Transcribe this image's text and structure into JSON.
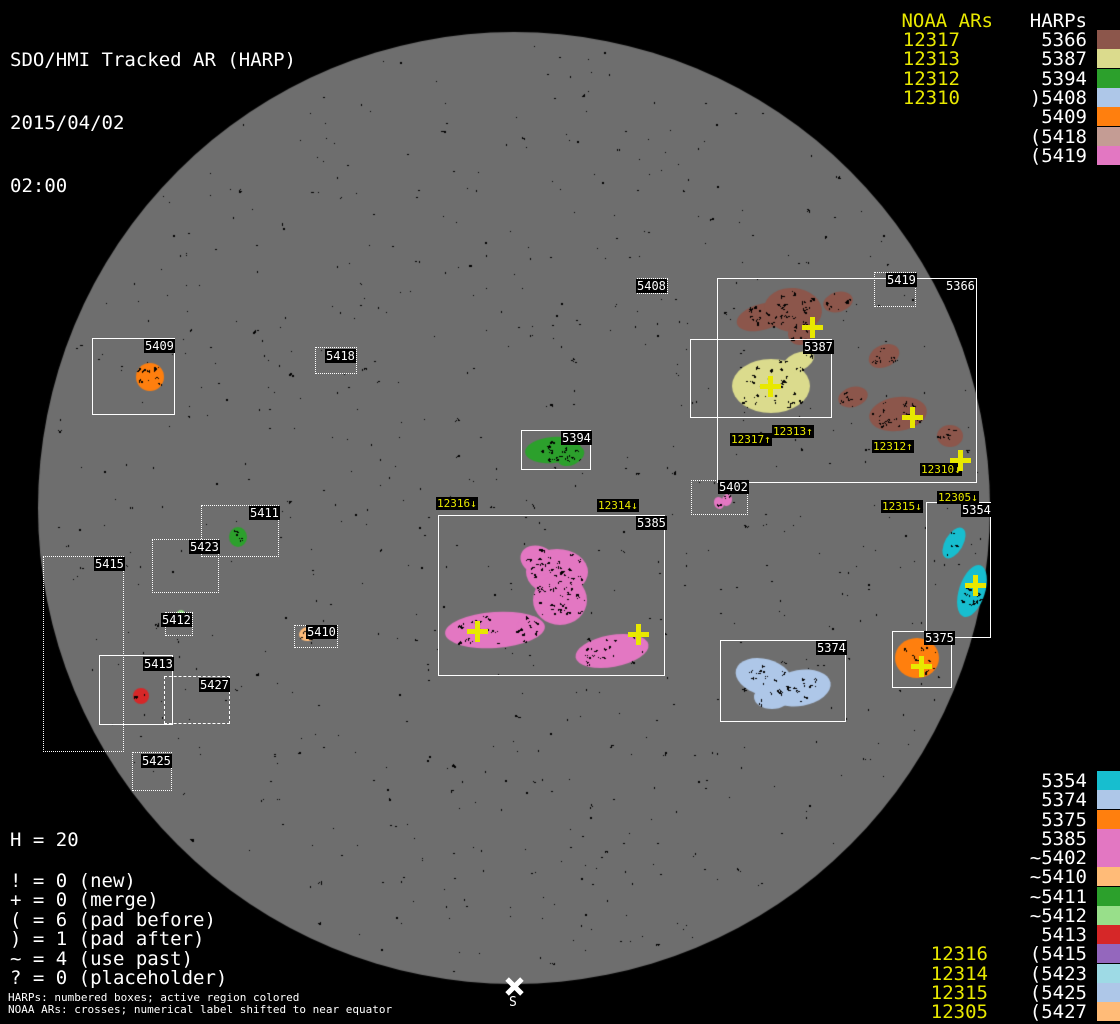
{
  "title": {
    "line1": "SDO/HMI Tracked AR (HARP)",
    "line2": "2015/04/02",
    "line3": "02:00"
  },
  "colors": {
    "background": "#000000",
    "disk_gray": "#6e6e6e",
    "box_white": "#ffffff",
    "noaa_yellow": "#e8e800",
    "label_bg": "#000000"
  },
  "disk": {
    "cx": 514,
    "cy": 508,
    "r": 476,
    "south_label": "S"
  },
  "legend_top_right": {
    "noaa_header": "NOAA ARs",
    "harp_header": "HARPs",
    "rows": [
      {
        "noaa": "12317",
        "label": "5366",
        "color": "#8c564b"
      },
      {
        "noaa": "12313",
        "label": "5387",
        "color": "#dbdb8d"
      },
      {
        "noaa": "12312",
        "label": "5394",
        "color": "#2ca02c"
      },
      {
        "noaa": "12310",
        "label": ")5408",
        "color": "#aec7e8"
      },
      {
        "noaa": "",
        "label": "5409",
        "color": "#ff7f0e"
      },
      {
        "noaa": "",
        "label": "(5418",
        "color": "#c49c94"
      },
      {
        "noaa": "",
        "label": "(5419",
        "color": "#e377c2"
      }
    ]
  },
  "legend_bottom_right": {
    "rows": [
      {
        "noaa": "",
        "label": "5354",
        "color": "#17becf"
      },
      {
        "noaa": "",
        "label": "5374",
        "color": "#aec7e8"
      },
      {
        "noaa": "",
        "label": "5375",
        "color": "#ff7f0e"
      },
      {
        "noaa": "",
        "label": "5385",
        "color": "#e377c2"
      },
      {
        "noaa": "",
        "label": "~5402",
        "color": "#e377c2"
      },
      {
        "noaa": "",
        "label": "~5410",
        "color": "#ffbb78"
      },
      {
        "noaa": "",
        "label": "~5411",
        "color": "#2ca02c"
      },
      {
        "noaa": "",
        "label": "~5412",
        "color": "#98df8a"
      },
      {
        "noaa": "",
        "label": "5413",
        "color": "#d62728"
      },
      {
        "noaa": "12316",
        "label": "(5415",
        "color": "#9467bd"
      },
      {
        "noaa": "12314",
        "label": "(5423",
        "color": "#9edae5"
      },
      {
        "noaa": "12315",
        "label": "(5425",
        "color": "#aec7e8"
      },
      {
        "noaa": "12305",
        "label": "(5427",
        "color": "#ffbb78"
      }
    ]
  },
  "stats": {
    "total": "H = 20",
    "items": [
      "! = 0 (new)",
      "+ = 0 (merge)",
      "( = 6 (pad before)",
      ") = 1 (pad after)",
      "~ = 4 (use past)",
      "? = 0 (placeholder)"
    ]
  },
  "footer": {
    "line1": "HARPs: numbered boxes; active region colored",
    "line2": "NOAA ARs: crosses; numerical label shifted to near equator"
  },
  "chart_data": {
    "type": "map",
    "title": "SDO/HMI Tracked AR (HARP)",
    "datetime": "2015/04/02 02:00",
    "harp_total": 20,
    "harp_boxes": [
      {
        "id": "5366",
        "x": 717,
        "y": 278,
        "w": 260,
        "h": 205,
        "border": "solid",
        "lx": 945,
        "ly": 279
      },
      {
        "id": "5419",
        "x": 874,
        "y": 272,
        "w": 42,
        "h": 35,
        "border": "dotted",
        "lx": 886,
        "ly": 273
      },
      {
        "id": "5387",
        "x": 690,
        "y": 339,
        "w": 142,
        "h": 79,
        "border": "solid",
        "lx": 803,
        "ly": 340
      },
      {
        "id": "5409",
        "x": 92,
        "y": 338,
        "w": 83,
        "h": 77,
        "border": "solid",
        "lx": 144,
        "ly": 339
      },
      {
        "id": "5418",
        "x": 315,
        "y": 347,
        "w": 42,
        "h": 27,
        "border": "dotted",
        "lx": 325,
        "ly": 349
      },
      {
        "id": "5408",
        "x": 637,
        "y": 278,
        "w": 31,
        "h": 16,
        "border": "dotted",
        "lx": 636,
        "ly": 279
      },
      {
        "id": "5394",
        "x": 521,
        "y": 430,
        "w": 70,
        "h": 40,
        "border": "solid",
        "lx": 561,
        "ly": 431
      },
      {
        "id": "5385",
        "x": 438,
        "y": 515,
        "w": 227,
        "h": 161,
        "border": "solid",
        "lx": 636,
        "ly": 516
      },
      {
        "id": "5402",
        "x": 691,
        "y": 480,
        "w": 57,
        "h": 35,
        "border": "dotted",
        "lx": 718,
        "ly": 480
      },
      {
        "id": "5354",
        "x": 926,
        "y": 502,
        "w": 65,
        "h": 136,
        "border": "solid",
        "lx": 961,
        "ly": 503
      },
      {
        "id": "5375",
        "x": 892,
        "y": 631,
        "w": 60,
        "h": 57,
        "border": "solid",
        "lx": 924,
        "ly": 631
      },
      {
        "id": "5374",
        "x": 720,
        "y": 640,
        "w": 126,
        "h": 82,
        "border": "solid",
        "lx": 816,
        "ly": 641
      },
      {
        "id": "5411",
        "x": 201,
        "y": 505,
        "w": 78,
        "h": 52,
        "border": "dotted",
        "lx": 249,
        "ly": 506
      },
      {
        "id": "5423",
        "x": 152,
        "y": 539,
        "w": 67,
        "h": 54,
        "border": "dotted",
        "lx": 189,
        "ly": 540
      },
      {
        "id": "5415",
        "x": 43,
        "y": 556,
        "w": 81,
        "h": 196,
        "border": "dotted",
        "lx": 94,
        "ly": 557
      },
      {
        "id": "5412",
        "x": 165,
        "y": 612,
        "w": 28,
        "h": 24,
        "border": "dotted",
        "lx": 161,
        "ly": 613
      },
      {
        "id": "5413",
        "x": 99,
        "y": 655,
        "w": 74,
        "h": 70,
        "border": "solid",
        "lx": 143,
        "ly": 657
      },
      {
        "id": "5427",
        "x": 164,
        "y": 676,
        "w": 66,
        "h": 48,
        "border": "dashed",
        "lx": 199,
        "ly": 678
      },
      {
        "id": "5425",
        "x": 132,
        "y": 752,
        "w": 40,
        "h": 39,
        "border": "dotted",
        "lx": 141,
        "ly": 754
      },
      {
        "id": "5410",
        "x": 294,
        "y": 625,
        "w": 44,
        "h": 23,
        "border": "dotted",
        "lx": 306,
        "ly": 625
      }
    ],
    "active_regions": [
      {
        "harp": "5409",
        "color": "#ff7f0e",
        "shapes": [
          {
            "cx": 150,
            "cy": 377,
            "rx": 14,
            "ry": 14,
            "rot": 0,
            "sp": 10
          }
        ]
      },
      {
        "harp": "5366",
        "color": "#8c564b",
        "shapes": [
          {
            "cx": 762,
            "cy": 317,
            "rx": 26,
            "ry": 13,
            "rot": -15,
            "sp": 12
          },
          {
            "cx": 793,
            "cy": 310,
            "rx": 29,
            "ry": 22,
            "rot": 5,
            "sp": 20
          },
          {
            "cx": 800,
            "cy": 334,
            "rx": 12,
            "ry": 11,
            "rot": 0,
            "sp": 6
          },
          {
            "cx": 838,
            "cy": 302,
            "rx": 15,
            "ry": 10,
            "rot": -15,
            "sp": 5
          },
          {
            "cx": 884,
            "cy": 356,
            "rx": 16,
            "ry": 11,
            "rot": -25,
            "sp": 6
          },
          {
            "cx": 853,
            "cy": 397,
            "rx": 15,
            "ry": 10,
            "rot": -15,
            "sp": 5
          },
          {
            "cx": 898,
            "cy": 414,
            "rx": 29,
            "ry": 17,
            "rot": -8,
            "sp": 16
          },
          {
            "cx": 950,
            "cy": 436,
            "rx": 13,
            "ry": 11,
            "rot": 0,
            "sp": 5
          }
        ]
      },
      {
        "harp": "5387",
        "color": "#dbdb8d",
        "shapes": [
          {
            "cx": 771,
            "cy": 386,
            "rx": 39,
            "ry": 27,
            "rot": 0,
            "sp": 22
          },
          {
            "cx": 798,
            "cy": 362,
            "rx": 17,
            "ry": 9,
            "rot": -25,
            "sp": 4
          }
        ]
      },
      {
        "harp": "5394",
        "color": "#2ca02c",
        "shapes": [
          {
            "cx": 553,
            "cy": 450,
            "rx": 28,
            "ry": 13,
            "rot": -5,
            "sp": 12
          },
          {
            "cx": 571,
            "cy": 456,
            "rx": 14,
            "ry": 9,
            "rot": -25,
            "sp": 4
          }
        ]
      },
      {
        "harp": "5385",
        "color": "#e377c2",
        "shapes": [
          {
            "cx": 557,
            "cy": 572,
            "rx": 31,
            "ry": 23,
            "rot": 0,
            "sp": 22
          },
          {
            "cx": 560,
            "cy": 600,
            "rx": 27,
            "ry": 25,
            "rot": 0,
            "sp": 22
          },
          {
            "cx": 538,
            "cy": 560,
            "rx": 18,
            "ry": 14,
            "rot": 20,
            "sp": 8
          },
          {
            "cx": 495,
            "cy": 630,
            "rx": 50,
            "ry": 18,
            "rot": -4,
            "sp": 20
          },
          {
            "cx": 530,
            "cy": 627,
            "rx": 13,
            "ry": 11,
            "rot": 0,
            "sp": 4
          },
          {
            "cx": 612,
            "cy": 651,
            "rx": 37,
            "ry": 16,
            "rot": -10,
            "sp": 14
          }
        ]
      },
      {
        "harp": "5402",
        "color": "#e377c2",
        "shapes": [
          {
            "cx": 719,
            "cy": 503,
            "rx": 5,
            "ry": 6,
            "rot": -20,
            "sp": 2
          },
          {
            "cx": 727,
            "cy": 500,
            "rx": 5,
            "ry": 6,
            "rot": 20,
            "sp": 2
          }
        ]
      },
      {
        "harp": "5354",
        "color": "#17becf",
        "shapes": [
          {
            "cx": 954,
            "cy": 543,
            "rx": 9,
            "ry": 17,
            "rot": 30,
            "sp": 4
          },
          {
            "cx": 972,
            "cy": 591,
            "rx": 13,
            "ry": 27,
            "rot": 18,
            "sp": 14
          }
        ]
      },
      {
        "harp": "5375",
        "color": "#ff7f0e",
        "shapes": [
          {
            "cx": 917,
            "cy": 658,
            "rx": 22,
            "ry": 20,
            "rot": 0,
            "sp": 10
          }
        ]
      },
      {
        "harp": "5374",
        "color": "#aec7e8",
        "shapes": [
          {
            "cx": 764,
            "cy": 677,
            "rx": 29,
            "ry": 18,
            "rot": 15,
            "sp": 10
          },
          {
            "cx": 800,
            "cy": 688,
            "rx": 31,
            "ry": 18,
            "rot": -10,
            "sp": 12
          },
          {
            "cx": 772,
            "cy": 697,
            "rx": 18,
            "ry": 12,
            "rot": 0,
            "sp": 5
          }
        ]
      },
      {
        "harp": "5411",
        "color": "#2ca02c",
        "shapes": [
          {
            "cx": 238,
            "cy": 537,
            "rx": 9,
            "ry": 10,
            "rot": 0,
            "sp": 3
          }
        ]
      },
      {
        "harp": "5412",
        "color": "#98df8a",
        "shapes": [
          {
            "cx": 181,
            "cy": 616,
            "rx": 5,
            "ry": 6,
            "rot": 0,
            "sp": 1
          }
        ]
      },
      {
        "harp": "5413",
        "color": "#d62728",
        "shapes": [
          {
            "cx": 141,
            "cy": 696,
            "rx": 8,
            "ry": 8,
            "rot": 0,
            "sp": 3
          }
        ]
      },
      {
        "harp": "5410",
        "color": "#ffbb78",
        "shapes": [
          {
            "cx": 308,
            "cy": 634,
            "rx": 9,
            "ry": 7,
            "rot": -10,
            "sp": 3
          }
        ]
      }
    ],
    "noaa_labels": [
      {
        "text": "12317↑",
        "x": 730,
        "y": 433
      },
      {
        "text": "12313↑",
        "x": 772,
        "y": 425
      },
      {
        "text": "12312↑",
        "x": 872,
        "y": 440
      },
      {
        "text": "12310↓",
        "x": 920,
        "y": 463
      },
      {
        "text": "12316↓",
        "x": 436,
        "y": 497
      },
      {
        "text": "12314↓",
        "x": 597,
        "y": 499
      },
      {
        "text": "12315↓",
        "x": 881,
        "y": 500
      },
      {
        "text": "12305↓",
        "x": 937,
        "y": 491
      }
    ],
    "crosses": [
      {
        "x": 812,
        "y": 327
      },
      {
        "x": 770,
        "y": 386
      },
      {
        "x": 912,
        "y": 417
      },
      {
        "x": 960,
        "y": 460
      },
      {
        "x": 477,
        "y": 631
      },
      {
        "x": 638,
        "y": 634
      },
      {
        "x": 975,
        "y": 585
      },
      {
        "x": 921,
        "y": 666
      }
    ]
  }
}
